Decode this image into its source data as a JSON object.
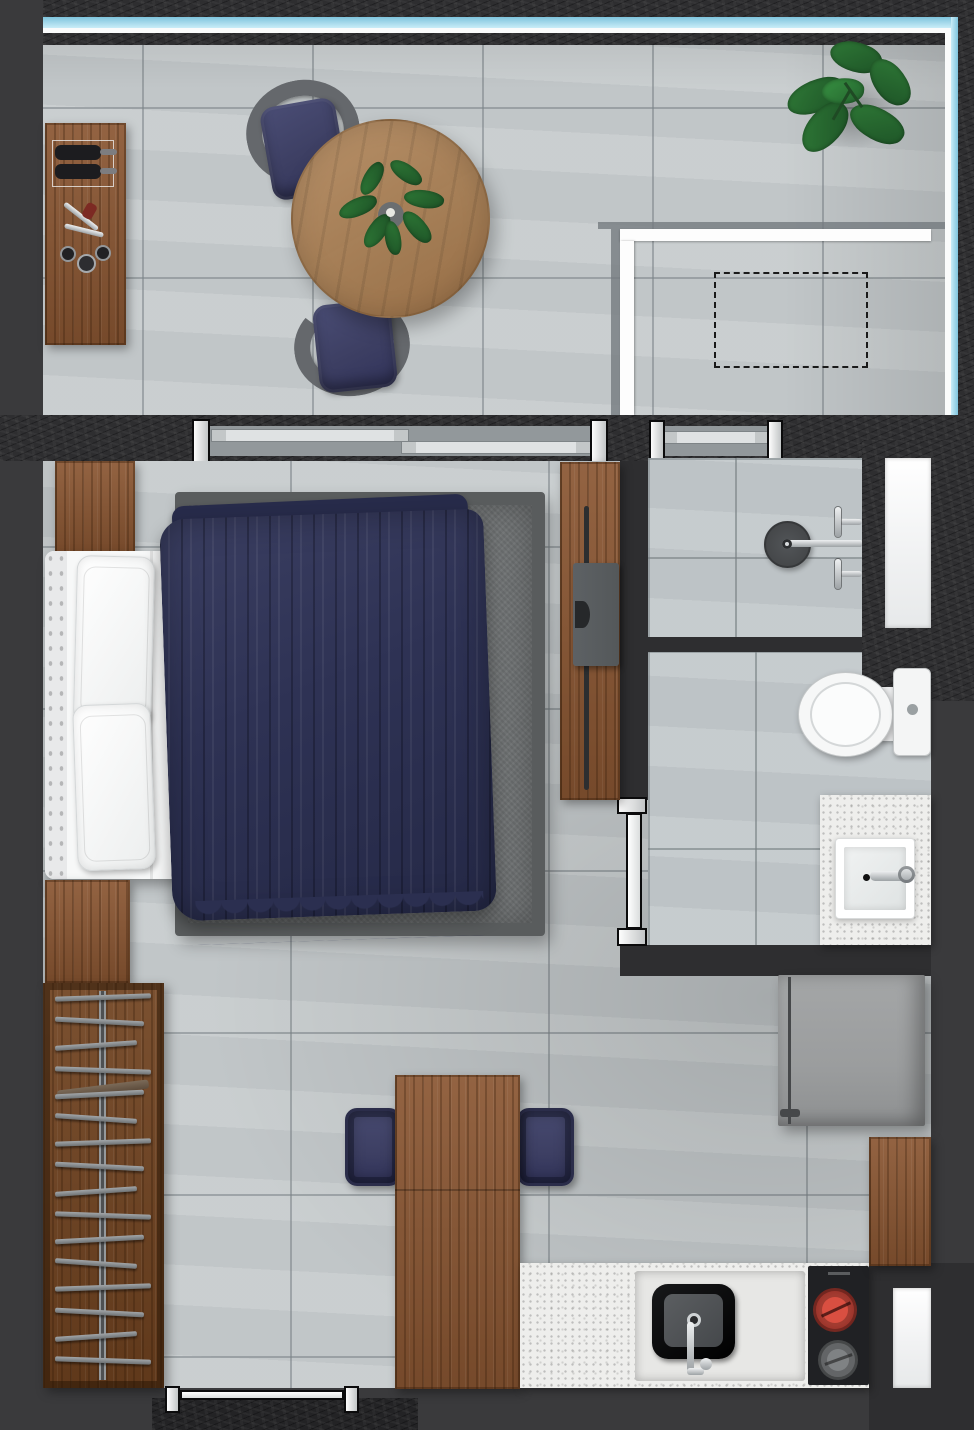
{
  "meta": {
    "title": "Studio Apartment Floor Plan",
    "view": "top-down 3d render",
    "canvas": {
      "width": 974,
      "height": 1430
    }
  },
  "palette": {
    "bg": "#3a3a3c",
    "wall": "#2e2e30",
    "floor": "#c7ccce",
    "bath_floor": "#c3c9cc",
    "wood": "#8a5632",
    "wood_dark": "#70421f",
    "oak": "#ab7e50",
    "navy": "#3d3f63",
    "navy_dark": "#2b2d4a",
    "duvet": "#2e3254",
    "rug": "#6f7273",
    "rug_border": "#595c5d",
    "linen": "#f6f7f7",
    "terrazzo": "#eeeeec",
    "appliance_gray": "#9b9d9e",
    "tv_gray": "#54585a",
    "glass_teal": "#a8dcf0",
    "burner_red": "#c7392f",
    "chrome": "#c9cdcf",
    "leaf_green": "#2f7a37",
    "leaf_dark": "#1d5226"
  },
  "rooms": {
    "balcony": {
      "id": "balcony",
      "features": [
        "glass-railing-north",
        "glass-railing-east",
        "tile-floor",
        "dashed-unit-outline",
        "white-parapet-line"
      ],
      "furniture": [
        {
          "name": "bar-sideboard",
          "material": "wood",
          "items": [
            "wine-bottle",
            "wine-bottle",
            "corkscrew",
            "glass",
            "glass",
            "glass"
          ]
        },
        {
          "name": "round-dining-table",
          "material": "oak",
          "centerpiece": "potted-plant"
        },
        {
          "name": "wicker-chair-north",
          "cushion": "navy"
        },
        {
          "name": "wicker-chair-south",
          "cushion": "navy"
        },
        {
          "name": "corner-floor-plant"
        }
      ]
    },
    "bedroom": {
      "id": "bedroom",
      "furniture": [
        {
          "name": "double-bed",
          "bedding": [
            "pillow",
            "pillow",
            "white-sheet",
            "navy-duvet"
          ]
        },
        {
          "name": "area-rug",
          "color": "gray"
        },
        {
          "name": "headboard-accent-panel",
          "material": "wood"
        },
        {
          "name": "media-panel",
          "material": "wood",
          "items": [
            "tv",
            "soundbar"
          ]
        },
        {
          "name": "bench-strip",
          "material": "wood"
        }
      ],
      "openings": [
        {
          "name": "balcony-sliding-door",
          "panels": 2
        }
      ]
    },
    "bathroom": {
      "id": "bathroom",
      "zones": [
        {
          "name": "shower-room",
          "fixtures": [
            "rain-shower-drain",
            "shower-pipe",
            "mixer-valve",
            "mixer-valve",
            "window"
          ],
          "openings": [
            {
              "name": "balcony-sliding-window",
              "panels": 1
            }
          ]
        },
        {
          "name": "wc",
          "fixtures": [
            "toilet",
            "vanity-counter",
            "square-sink",
            "sink-faucet"
          ],
          "openings": [
            {
              "name": "swing-door"
            }
          ]
        }
      ]
    },
    "kitchen": {
      "id": "kitchen-living",
      "furniture": [
        {
          "name": "counter",
          "surface": "terrazzo",
          "fixtures": [
            "black-sink",
            "kitchen-faucet",
            "cooktop"
          ]
        },
        {
          "name": "cooktop",
          "burners": [
            {
              "state": "on",
              "color": "red"
            },
            {
              "state": "off",
              "color": "gray"
            }
          ]
        },
        {
          "name": "refrigerator",
          "color": "gray"
        },
        {
          "name": "tall-cabinet",
          "material": "wood"
        },
        {
          "name": "dining-table",
          "material": "wood"
        },
        {
          "name": "stool-west",
          "cushion": "navy"
        },
        {
          "name": "stool-east",
          "cushion": "navy"
        },
        {
          "name": "window"
        }
      ]
    },
    "entry": {
      "id": "entry",
      "furniture": [
        {
          "name": "open-wardrobe",
          "material": "wood",
          "hanger_count": 16,
          "has_rail": true
        }
      ],
      "openings": [
        {
          "name": "entrance-door"
        }
      ],
      "features": [
        "doormat"
      ]
    }
  }
}
